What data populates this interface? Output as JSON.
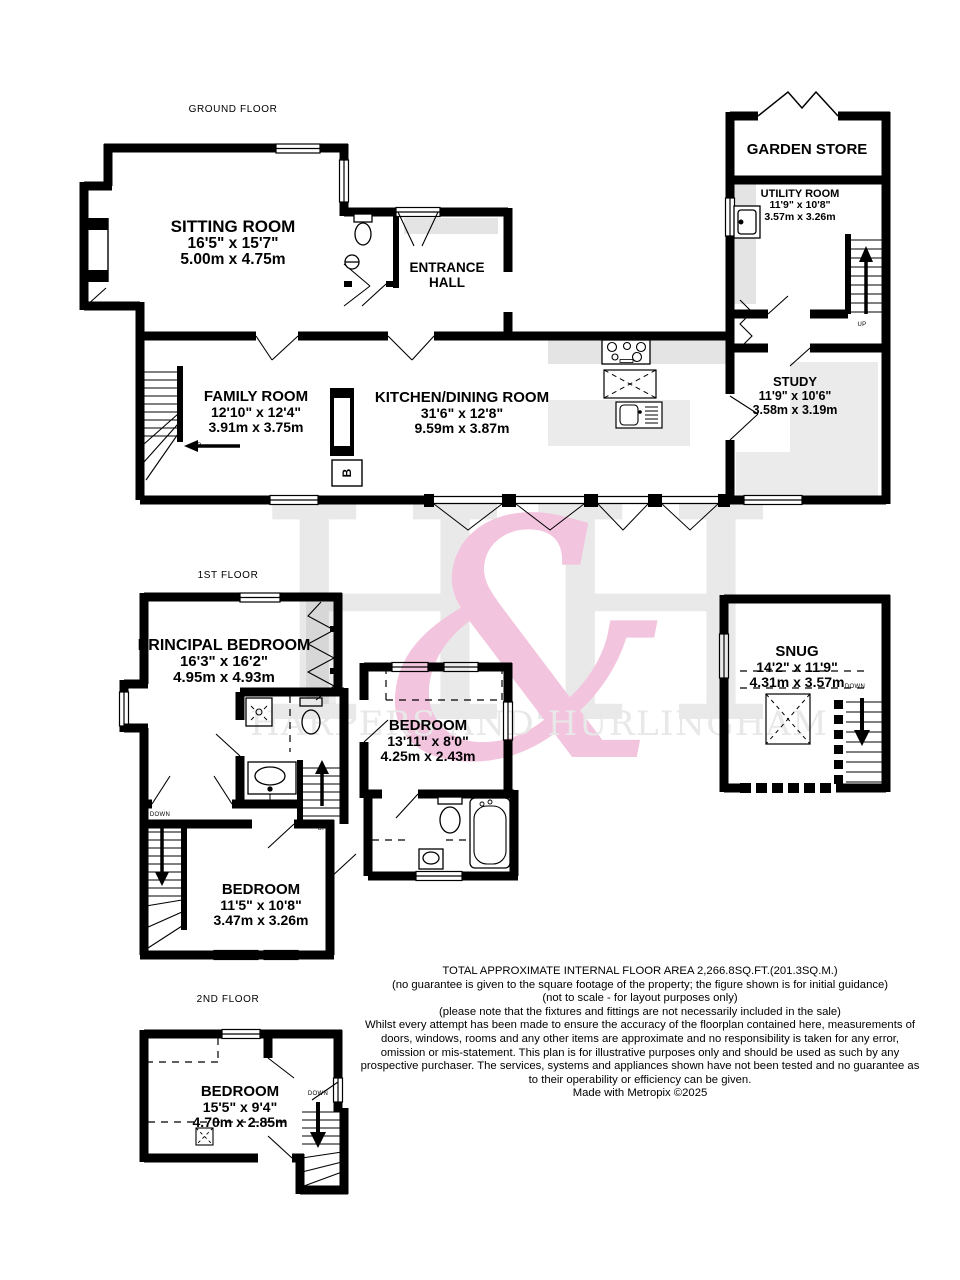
{
  "watermark": {
    "monogram_left": "H",
    "monogram_amp": "&",
    "monogram_right": "H",
    "name": "HARPERS AND HURLINGHAM",
    "pink": "#f3c4de",
    "gray": "#e9e9e9"
  },
  "markers": {
    "up": "UP",
    "down": "DOWN",
    "boiler": "B"
  },
  "floors": [
    {
      "label": "GROUND FLOOR",
      "rooms": [
        {
          "name": "SITTING ROOM",
          "ft": "16'5\" x 15'7\"",
          "m": "5.00m x 4.75m"
        },
        {
          "name": "ENTRANCE HALL"
        },
        {
          "name": "FAMILY ROOM",
          "ft": "12'10\" x 12'4\"",
          "m": "3.91m x 3.75m"
        },
        {
          "name": "KITCHEN/DINING ROOM",
          "ft": "31'6\" x 12'8\"",
          "m": "9.59m x 3.87m"
        },
        {
          "name": "GARDEN STORE"
        },
        {
          "name": "UTILITY ROOM",
          "ft": "11'9\" x 10'8\"",
          "m": "3.57m x 3.26m"
        },
        {
          "name": "STUDY",
          "ft": "11'9\" x 10'6\"",
          "m": "3.58m x 3.19m"
        }
      ]
    },
    {
      "label": "1ST FLOOR",
      "rooms": [
        {
          "name": "PRINCIPAL BEDROOM",
          "ft": "16'3\" x 16'2\"",
          "m": "4.95m x 4.93m"
        },
        {
          "name": "BEDROOM",
          "ft": "13'11\" x 8'0\"",
          "m": "4.25m x 2.43m"
        },
        {
          "name": "BEDROOM",
          "ft": "11'5\" x 10'8\"",
          "m": "3.47m x 3.26m"
        },
        {
          "name": "SNUG",
          "ft": "14'2\" x 11'9\"",
          "m": "4.31m x 3.57m"
        }
      ]
    },
    {
      "label": "2ND FLOOR",
      "rooms": [
        {
          "name": "BEDROOM",
          "ft": "15'5\" x 9'4\"",
          "m": "4.70m x 2.85m"
        }
      ]
    }
  ],
  "footer": {
    "area": "TOTAL APPROXIMATE INTERNAL FLOOR AREA 2,266.8SQ.FT.(201.3SQ.M.)",
    "guarantee": "(no guarantee is given to the square footage of the property; the figure shown is for initial guidance)",
    "scale": "(not to scale - for layout purposes only)",
    "fixtures": "(please note that the fixtures and fittings are not necessarily included in the sale)",
    "disclaimer": "Whilst every attempt has been made to ensure the accuracy of the floorplan contained here, measurements of doors, windows, rooms and any other items are approximate and no responsibility is taken for any error, omission or mis-statement. This plan is for illustrative purposes only and should be used as such by any prospective purchaser. The services, systems and appliances shown have not been tested and no guarantee as to their operability or efficiency can be given.",
    "credit": "Made with Metropix ©2025"
  }
}
